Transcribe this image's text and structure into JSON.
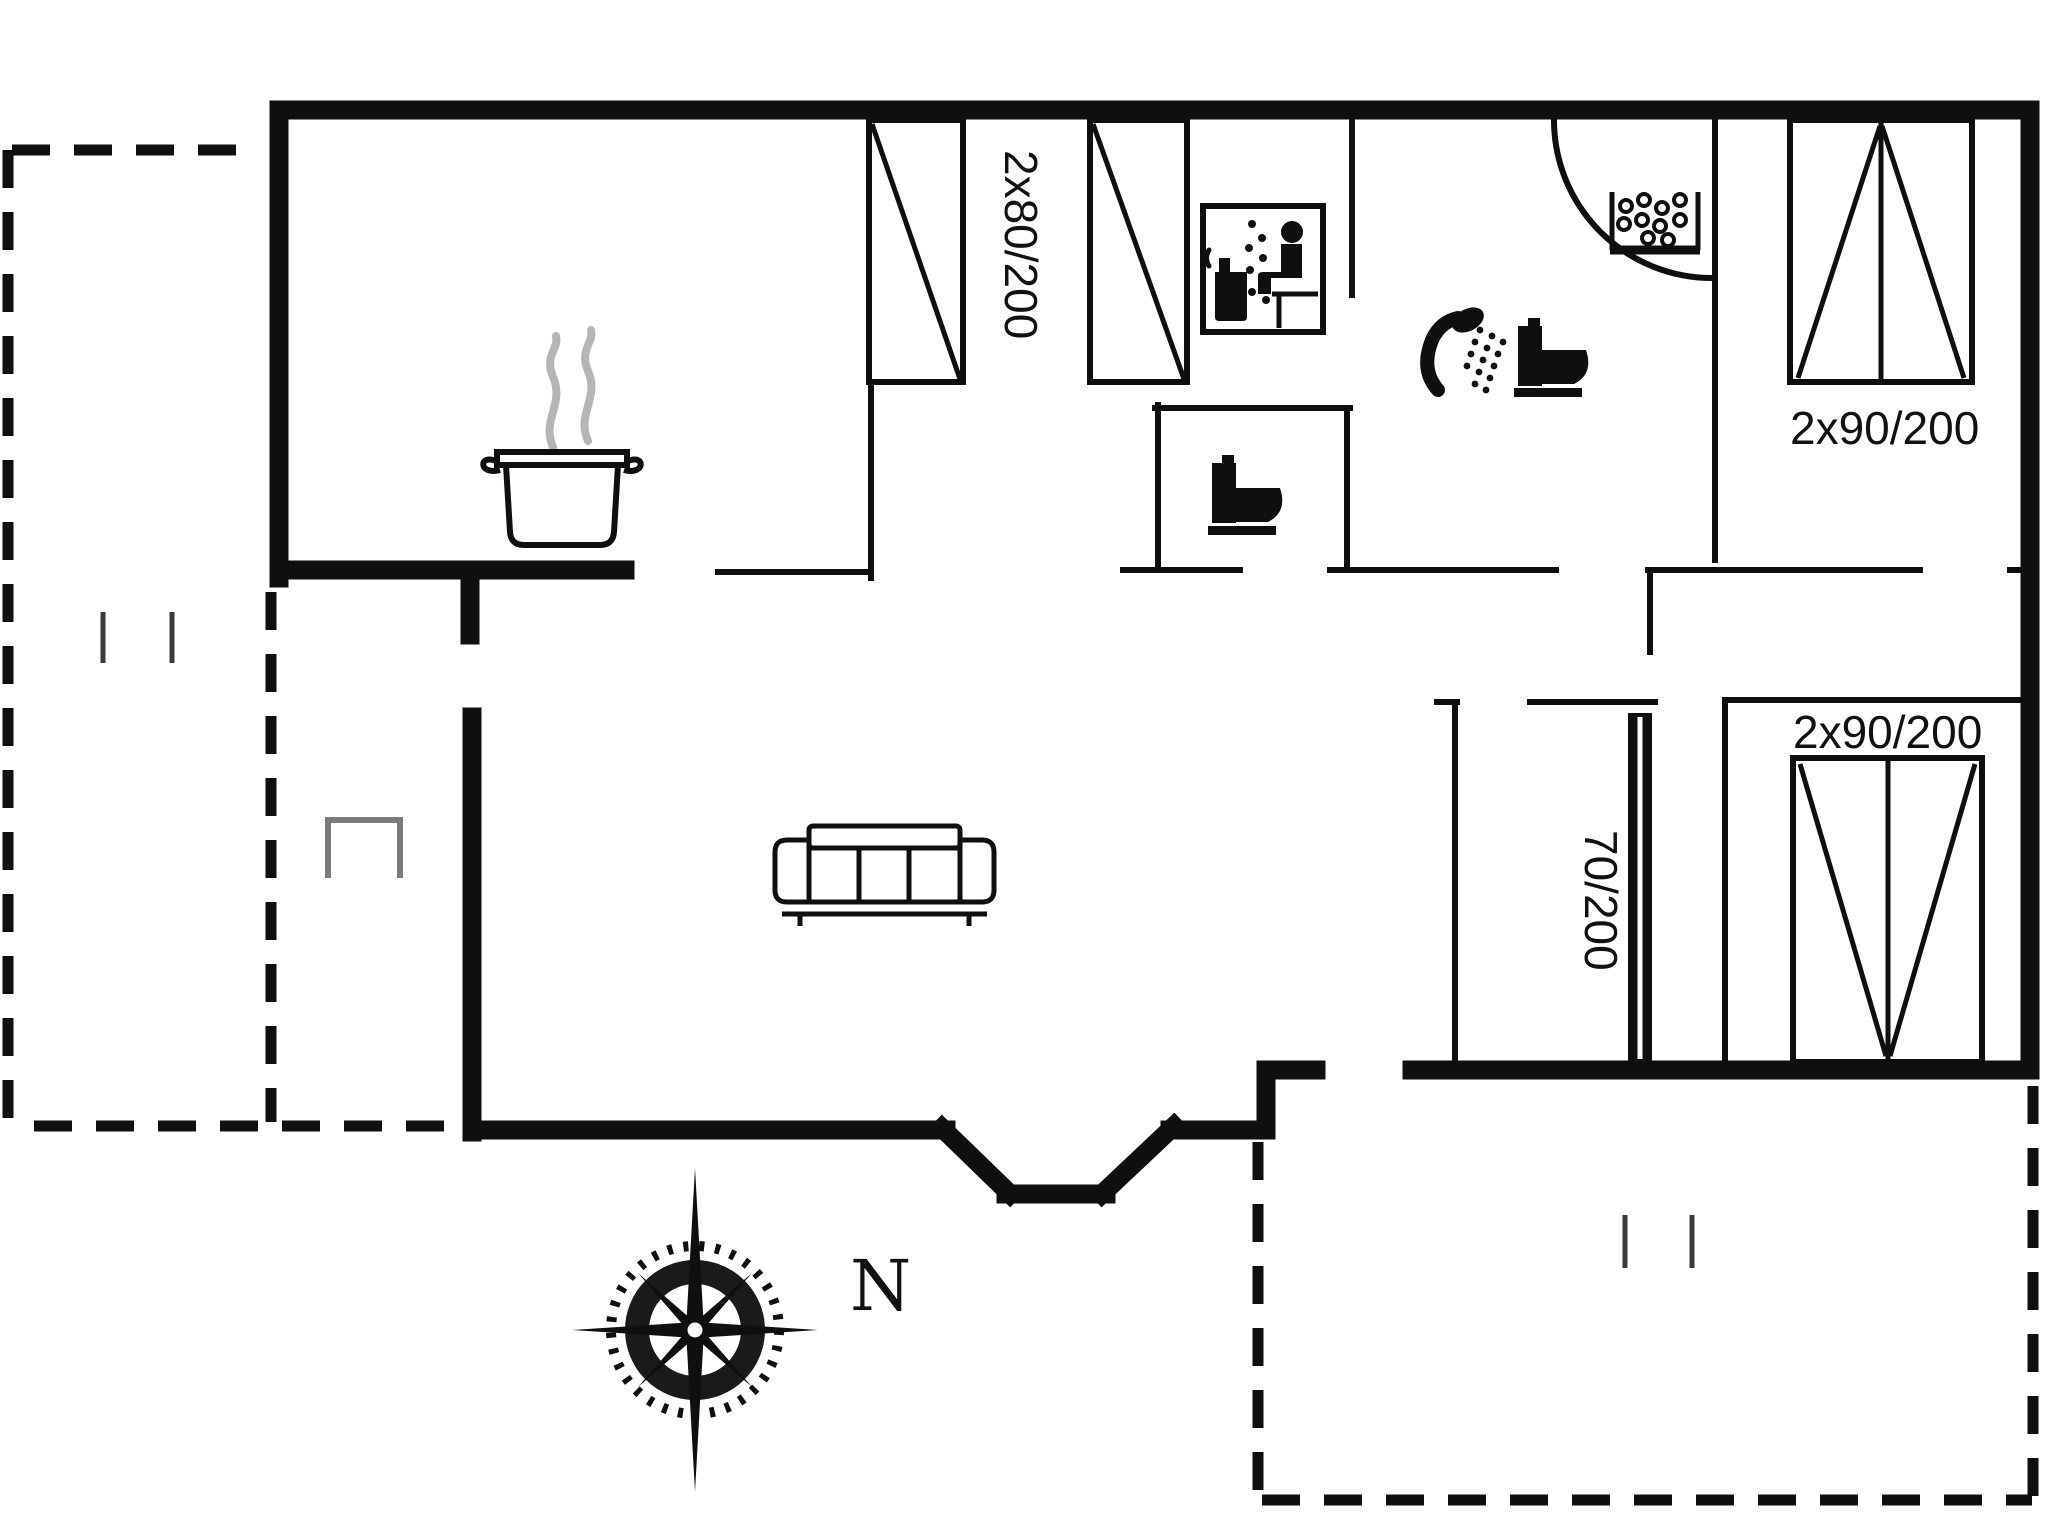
{
  "labels": {
    "closet_doors": "2x80/200",
    "window_top_right": "2x90/200",
    "window_bottom_right": "2x90/200",
    "interior_sliding_door": "70/200",
    "compass_north": "N"
  },
  "icons": [
    "cooking-pot-icon",
    "sauna-icon",
    "toilet-icon",
    "toilet-icon",
    "shower-icon",
    "washbasin-icon",
    "sofa-icon",
    "compass-rose-icon"
  ],
  "colors": {
    "line": "#0f0f0f",
    "steam_gray": "#b5b5b5",
    "step_gray": "#7a7a7a",
    "background": "#ffffff"
  }
}
